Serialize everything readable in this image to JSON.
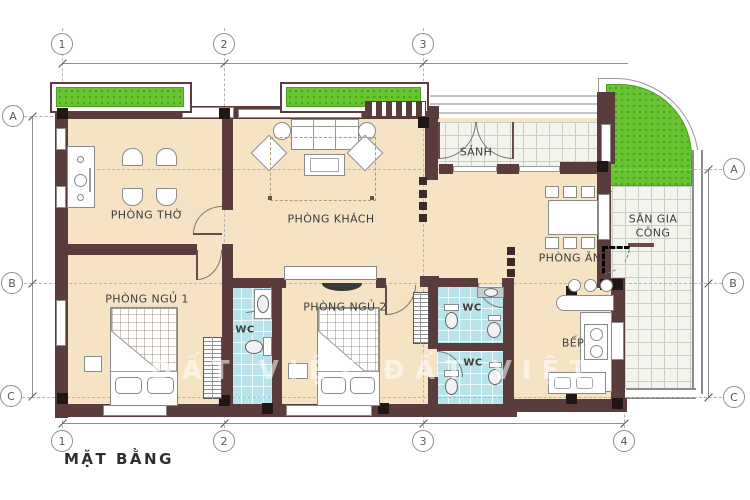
{
  "title": "MẶT BẰNG",
  "watermark": "ĐẤT VIỆT ĐẤT VIỆT",
  "grid": {
    "top": [
      "1",
      "2",
      "3"
    ],
    "bottom": [
      "1",
      "2",
      "3",
      "4"
    ],
    "left": [
      "A",
      "B",
      "C"
    ],
    "right": [
      "A",
      "B",
      "C"
    ]
  },
  "rooms": {
    "worship": "PHÒNG THỜ",
    "living": "PHÒNG KHÁCH",
    "lobby": "SẢNH",
    "dining": "PHÒNG ĂN",
    "work_yard": "SÂN GIA CÔNG",
    "kitchen": "BẾP",
    "bedroom1": "PHÒNG NGỦ 1",
    "bedroom2": "PHÒNG NGỦ 2",
    "wc": "WC"
  },
  "colors": {
    "wall": "#5a3c3c",
    "column": "#201616",
    "floor": "#f5e3c4",
    "wc_floor": "#b9e3eb",
    "tile_floor": "#f3f4ee",
    "grass": "#68c531",
    "line": "#999999"
  }
}
